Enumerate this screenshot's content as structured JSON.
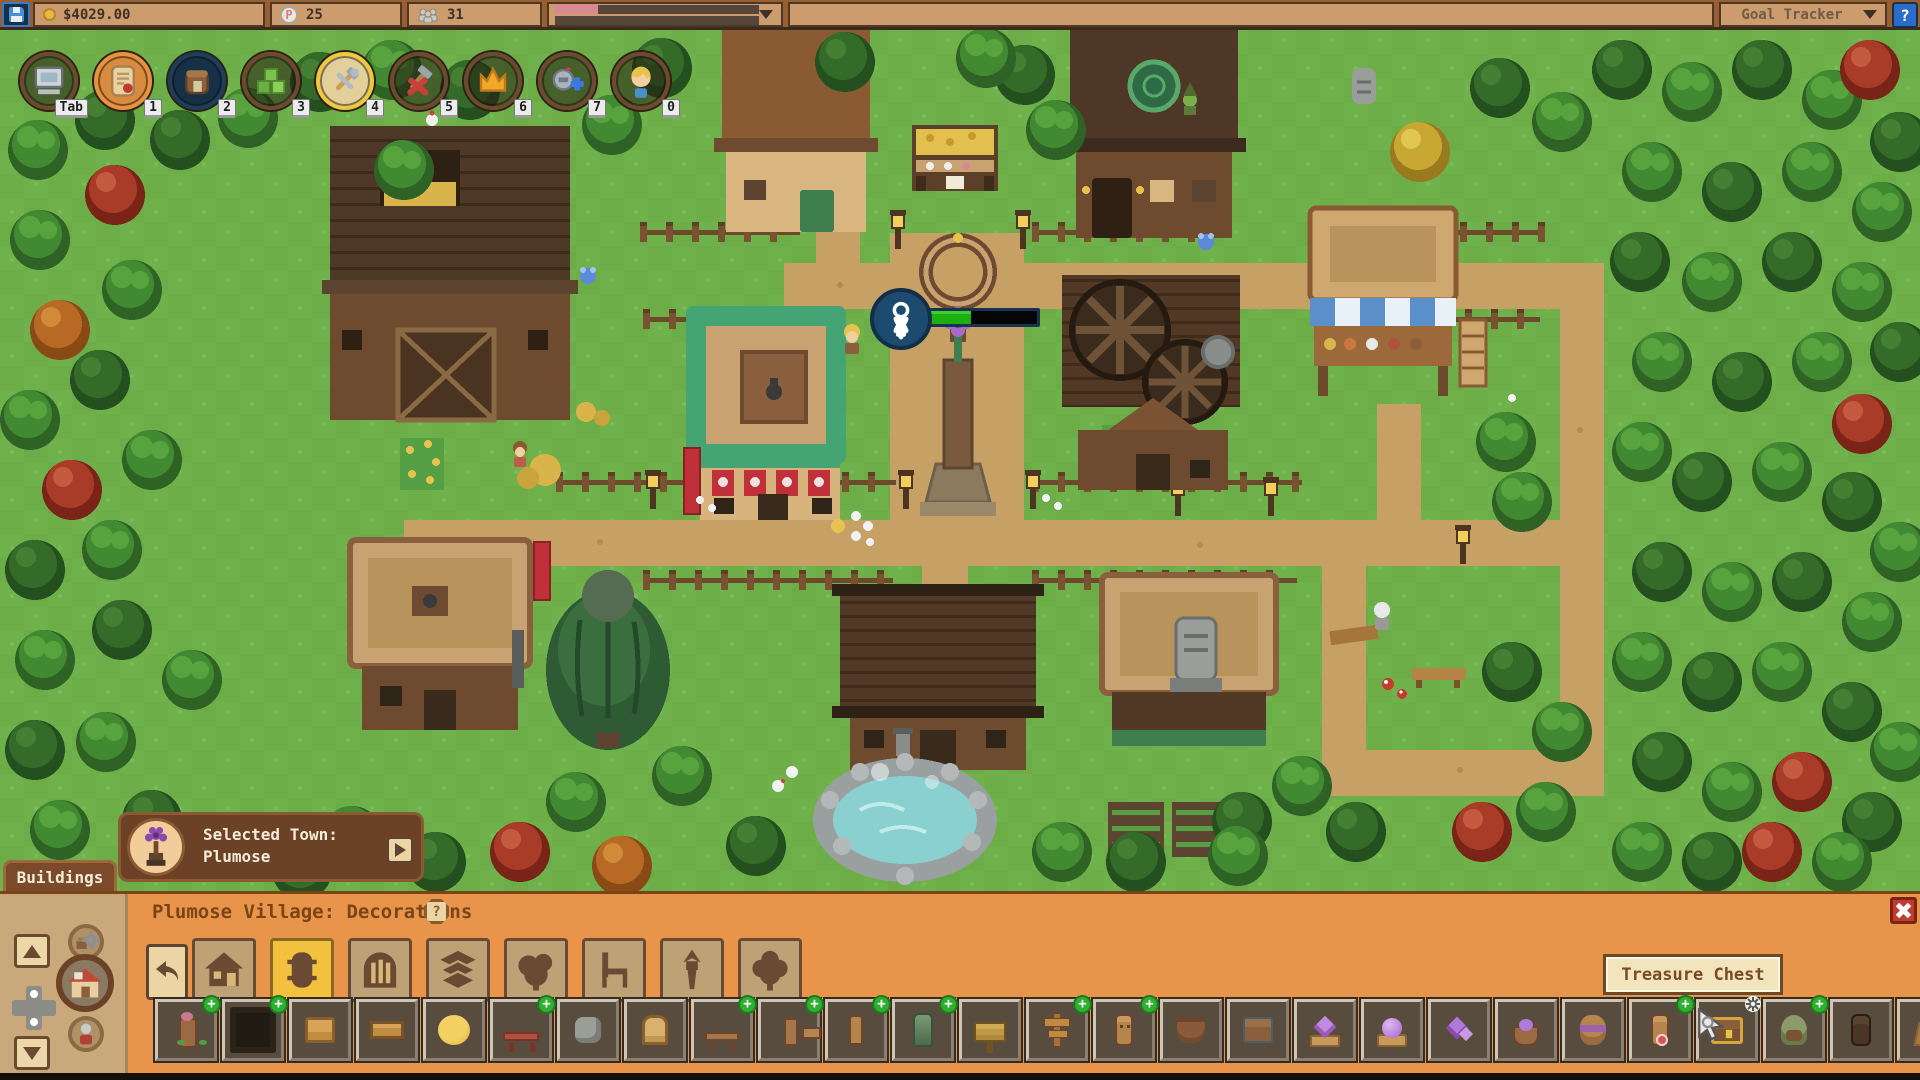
{
  "top_bar": {
    "money": "$4029.00",
    "dewdrop_letter": "P",
    "dewdrops": "25",
    "population": "31",
    "goal_tracker_label": "Goal Tracker",
    "help_label": "?",
    "exp_bar_fill_percent": 21
  },
  "hotbar": [
    {
      "key": "Tab",
      "icon": "computer"
    },
    {
      "key": "1",
      "icon": "scroll",
      "ring": "orange"
    },
    {
      "key": "2",
      "icon": "backpack",
      "ring": "navy"
    },
    {
      "key": "3",
      "icon": "terrain"
    },
    {
      "key": "4",
      "icon": "build-tools",
      "ring": "gold"
    },
    {
      "key": "5",
      "icon": "demolish"
    },
    {
      "key": "6",
      "icon": "crown"
    },
    {
      "key": "7",
      "icon": "armor"
    },
    {
      "key": "0",
      "icon": "player"
    }
  ],
  "map_overlay": {
    "selected_town_label": "Selected Town:",
    "town_name": "Plumose",
    "villager_progress_percent": 38
  },
  "buildings_tab_label": "Buildings",
  "panel": {
    "title": "Plumose Village: Decorations",
    "help_icon": "?",
    "tooltip": "Treasure Chest",
    "categories": [
      {
        "icon": "house"
      },
      {
        "icon": "barrel",
        "selected": true
      },
      {
        "icon": "arch-gate"
      },
      {
        "icon": "floor-tiles"
      },
      {
        "icon": "bush"
      },
      {
        "icon": "chair"
      },
      {
        "icon": "torch"
      },
      {
        "icon": "tree"
      }
    ],
    "items": [
      {
        "icon": "flower-statue",
        "sprite": "totemflower",
        "plus": true
      },
      {
        "icon": "shadow-ring",
        "sprite": "dark",
        "plus": true
      },
      {
        "icon": "wooden-crate",
        "sprite": "crate"
      },
      {
        "icon": "wooden-shelf",
        "sprite": "shelf"
      },
      {
        "icon": "hay-bale",
        "sprite": "hay"
      },
      {
        "icon": "red-bench",
        "sprite": "redbench",
        "plus": true
      },
      {
        "icon": "stone-seat",
        "sprite": "stone"
      },
      {
        "icon": "wooden-door",
        "sprite": "door"
      },
      {
        "icon": "wooden-bench",
        "sprite": "bench",
        "plus": true
      },
      {
        "icon": "sign-arm",
        "sprite": "signarm",
        "plus": true
      },
      {
        "icon": "wooden-post",
        "sprite": "post",
        "plus": true
      },
      {
        "icon": "vine-pillar",
        "sprite": "vine",
        "plus": true
      },
      {
        "icon": "wooden-sign",
        "sprite": "sign"
      },
      {
        "icon": "arrow-signpost",
        "sprite": "signpost",
        "plus": true
      },
      {
        "icon": "carved-totem",
        "sprite": "totem",
        "plus": true
      },
      {
        "icon": "clay-pot",
        "sprite": "pot"
      },
      {
        "icon": "storage-chest",
        "sprite": "chest2"
      },
      {
        "icon": "amethyst-stand",
        "sprite": "crystalstand"
      },
      {
        "icon": "amethyst-orb",
        "sprite": "orb"
      },
      {
        "icon": "crystal-cluster",
        "sprite": "cluster"
      },
      {
        "icon": "crystal-basket",
        "sprite": "basket"
      },
      {
        "icon": "purple-bundle",
        "sprite": "wrap"
      },
      {
        "icon": "tribal-totem",
        "sprite": "redtotem",
        "plus": true
      },
      {
        "icon": "treasure-chest",
        "sprite": "chest",
        "hovered": true,
        "badge": "gear"
      },
      {
        "icon": "mossy-idol",
        "sprite": "moss",
        "plus": true
      },
      {
        "icon": "dark-totem",
        "sprite": "darktotem"
      },
      {
        "icon": "wooden-cart",
        "sprite": "cart"
      }
    ]
  },
  "colors": {
    "panel_orange": "#e8954b",
    "panel_tan": "#c9a97b",
    "ui_brown": "#6b4226",
    "selected_yellow": "#f2c23f",
    "plus_green": "#2fae2f",
    "hp_green": "#1fae10",
    "exp_pink": "#d88a94",
    "grass": "#6fb14b",
    "path": "#c7a066"
  }
}
